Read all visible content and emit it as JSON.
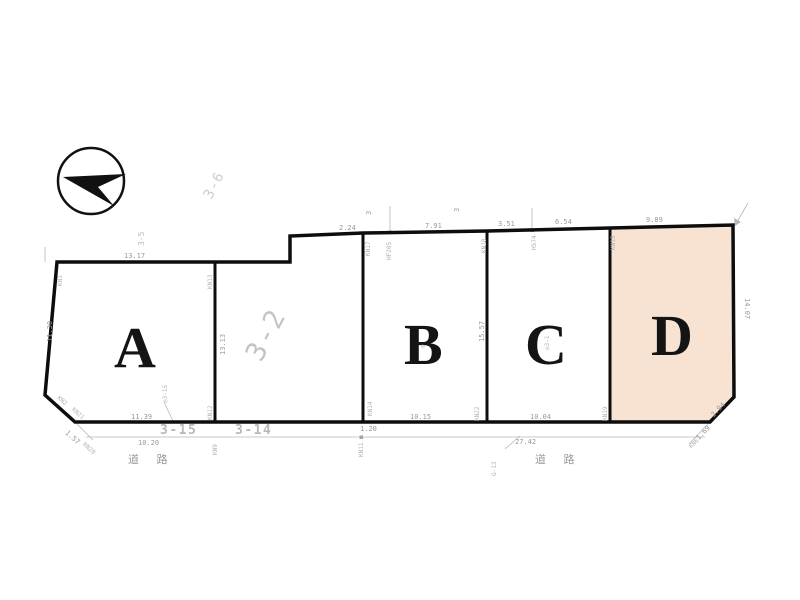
{
  "drawing": {
    "type": "land-subdivision-plan",
    "highlight_color": "#f8e3d3",
    "outline_color": "#0d0d0d"
  },
  "parcels": {
    "a": "A",
    "b": "B",
    "c": "C",
    "d": "D",
    "middle_lot": "3-2"
  },
  "dimensions": {
    "a_top": "13.17",
    "a_left": "11.30",
    "a_bottom": "11.39",
    "a_chamfer_below": "1.57",
    "b_top_1": "2.24",
    "b_top_2": "7.91",
    "b_bottom": "10.15",
    "c_top_1": "3.51",
    "c_top_2": "6.54",
    "c_bottom": "10.04",
    "d_top": "9.89",
    "d_right": "14.07",
    "d_chamfer": "2.94",
    "d_chamfer_below": "1.69",
    "ab_boundary": "13.13",
    "bc_boundary": "15.57",
    "road_left": "10.20",
    "road_total": "27.42",
    "segment_small": "1.20"
  },
  "survey_points": {
    "kn1": "KN1",
    "kn13": "KN13",
    "kn17": "KN17",
    "hf205": "HF205",
    "kn18": "KN18",
    "h574": "H574",
    "kn15": "KN15",
    "kn19": "KN19",
    "kn22": "KN22",
    "kn14": "KN14",
    "kn12": "KN12",
    "kn9": "KN9",
    "kn11": "KN11",
    "kn2": "KN2",
    "kn21": "KN21",
    "kn20": "KN20",
    "kn6": "KN6",
    "g13": "G-13"
  },
  "neighbor_lots": {
    "left_top": "3-6",
    "left_side": "3-5",
    "top_b": "3",
    "top_c": "3",
    "road_lot_1": "3-15",
    "road_lot_2": "3-14",
    "stamp_a": "◎3-15",
    "stamp_b": "◎",
    "stamp_c": "◎3-1"
  },
  "road": {
    "label": "道 路"
  }
}
